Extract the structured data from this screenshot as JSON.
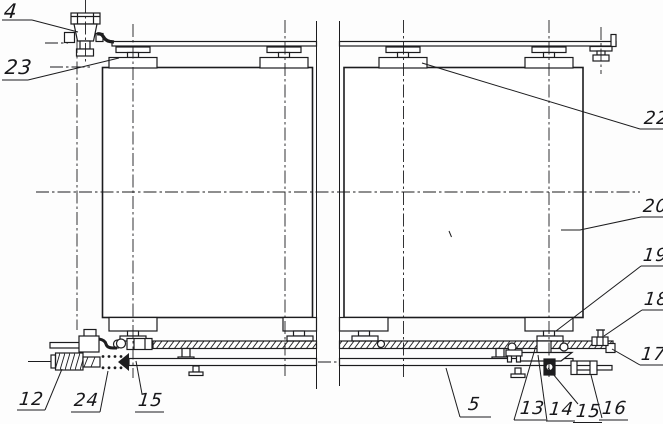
{
  "figure": {
    "kind": "mechanical patent-style line drawing, two suspended drums on overhead rail with lower guide rail and screw tensioner",
    "part_labels": {
      "l4": "4",
      "l23": "23",
      "l22": "22",
      "l20": "20",
      "l19": "19",
      "l18": "18",
      "l17": "17",
      "l12": "12",
      "l24": "24",
      "l15a": "15",
      "l5": "5",
      "l13": "13",
      "l14": "14",
      "l15b": "15",
      "l16": "16"
    },
    "ink_color": "#1c1c1e",
    "paper_color": "#fdfdfd"
  }
}
